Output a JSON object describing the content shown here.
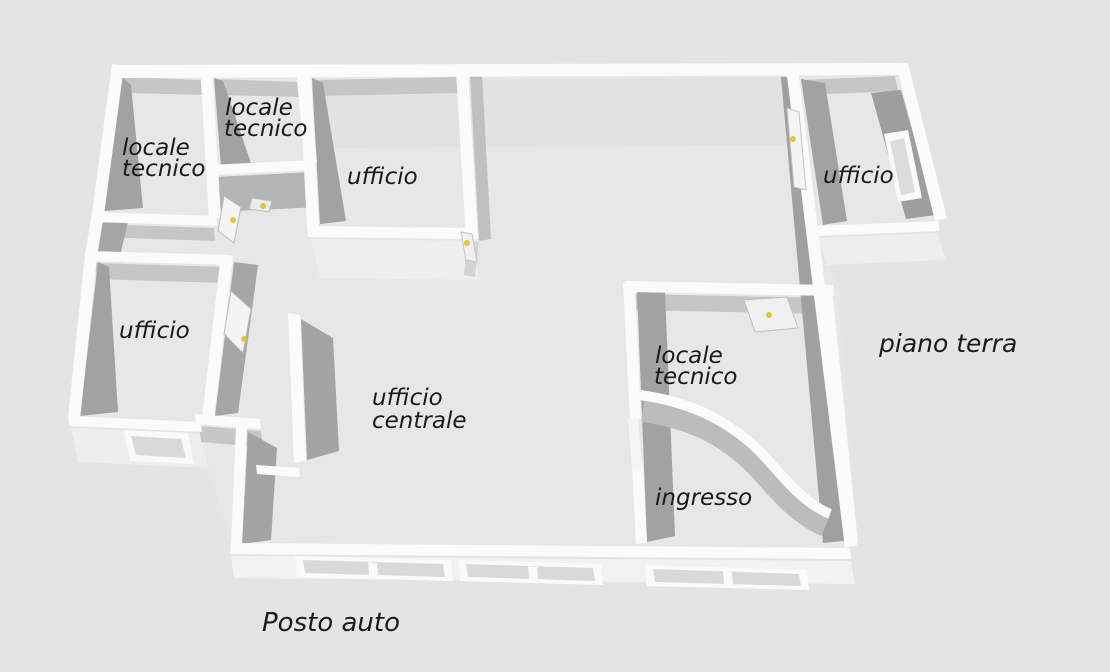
{
  "scene": {
    "type": "3d-floor-plan-render",
    "floor_label": "piano terra",
    "outside_label": "Posto auto"
  },
  "rooms": {
    "locale_tecnico_nw": {
      "label_line1": "locale",
      "label_line2": "tecnico"
    },
    "locale_tecnico_n": {
      "label_line1": "locale",
      "label_line2": "tecnico"
    },
    "ufficio_n": {
      "label": "ufficio"
    },
    "ufficio_e": {
      "label": "ufficio"
    },
    "ufficio_w": {
      "label": "ufficio"
    },
    "ufficio_centrale": {
      "label_line1": "ufficio",
      "label_line2": "centrale"
    },
    "locale_tecnico_e": {
      "label_line1": "locale",
      "label_line2": "tecnico"
    },
    "ingresso": {
      "label": "ingresso"
    }
  },
  "colors": {
    "background": "#e4e4e4",
    "floor": "#e7e7e7",
    "wall_top": "#fbfbfb",
    "wall_face_dark": "#a2a2a2",
    "wall_face_mid": "#c6c6c6",
    "wall_face_light": "#eeeeee",
    "exterior_wall": "#f2f2f2",
    "window_pane": "#d9d9d9",
    "door_handle_yellow": "#d9c84a",
    "label_text": "#1a1a1a"
  }
}
